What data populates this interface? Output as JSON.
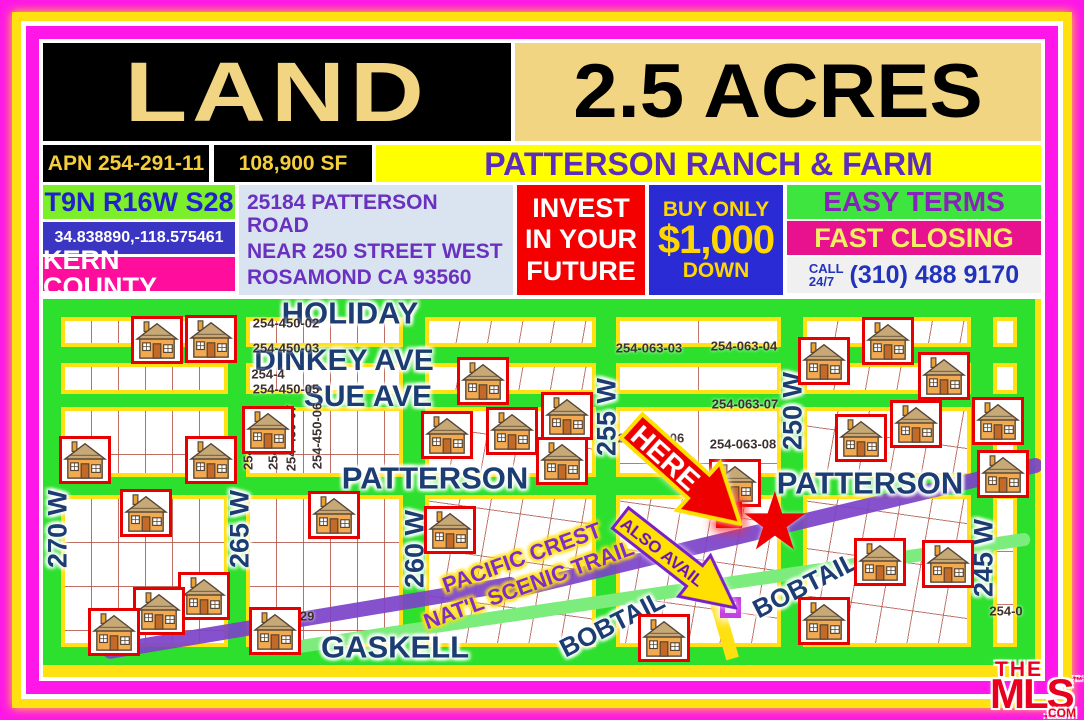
{
  "header": {
    "land": "LAND",
    "acres": "2.5 ACRES"
  },
  "info": {
    "apn": "APN 254-291-11",
    "sqft": "108,900 SF",
    "ranch_title": "PATTERSON RANCH & FARM",
    "township": "T9N R16W S28",
    "gps": "34.838890,-118.575461",
    "county": "KERN COUNTY",
    "address_line1": "25184 PATTERSON ROAD",
    "address_line2": "NEAR 250 STREET WEST",
    "address_line3": "ROSAMOND CA 93560"
  },
  "offer": {
    "invest_l1": "INVEST",
    "invest_l2": "IN YOUR",
    "invest_l3": "FUTURE",
    "buy_line1": "BUY ONLY",
    "amount": "$1,000",
    "buy_line2": "DOWN",
    "easy": "EASY TERMS",
    "fast": "FAST CLOSING",
    "call_l1": "CALL",
    "call_l2": "24/7",
    "phone": "(310) 488 9170"
  },
  "map": {
    "here_label": "HERE",
    "also_label": "ALSO AVAIL",
    "star_glyph": "★",
    "trail_label1": "PACIFIC CREST",
    "trail_label2": "NAT'L SCENIC TRAIL",
    "streets": [
      {
        "label": "HOLIDAY",
        "x": 307,
        "y": 14,
        "rot": 0,
        "fs": 31
      },
      {
        "label": "DINKEY AVE",
        "x": 301,
        "y": 62,
        "rot": 0,
        "fs": 30
      },
      {
        "label": "SUE AVE",
        "x": 325,
        "y": 98,
        "rot": 0,
        "fs": 30
      },
      {
        "label": "PATTERSON",
        "x": 392,
        "y": 179,
        "rot": 0,
        "fs": 31
      },
      {
        "label": "PATTERSON",
        "x": 827,
        "y": 184,
        "rot": 0,
        "fs": 31
      },
      {
        "label": "GASKELL",
        "x": 352,
        "y": 348,
        "rot": 0,
        "fs": 31
      },
      {
        "label": "BOBTAIL",
        "x": 569,
        "y": 325,
        "rot": -27,
        "fs": 26
      },
      {
        "label": "BOBTAIL",
        "x": 762,
        "y": 286,
        "rot": -27,
        "fs": 26
      },
      {
        "label": "270 W",
        "x": 15,
        "y": 230,
        "rot": -90,
        "fs": 27
      },
      {
        "label": "265 W",
        "x": 197,
        "y": 230,
        "rot": -90,
        "fs": 27
      },
      {
        "label": "260 W",
        "x": 372,
        "y": 250,
        "rot": -90,
        "fs": 27
      },
      {
        "label": "255 W",
        "x": 564,
        "y": 118,
        "rot": -90,
        "fs": 27
      },
      {
        "label": "250 W",
        "x": 750,
        "y": 112,
        "rot": -90,
        "fs": 27
      },
      {
        "label": "245 W",
        "x": 941,
        "y": 259,
        "rot": -90,
        "fs": 27
      }
    ],
    "parcels": [
      {
        "label": "254-450-02",
        "x": 243,
        "y": 24,
        "rot": 0
      },
      {
        "label": "254-450-03",
        "x": 243,
        "y": 49,
        "rot": 0
      },
      {
        "label": "254-4",
        "x": 225,
        "y": 75,
        "rot": 0
      },
      {
        "label": "254-450-05",
        "x": 243,
        "y": 90,
        "rot": 0
      },
      {
        "label": "254-",
        "x": 205,
        "y": 158,
        "rot": -90
      },
      {
        "label": "254-",
        "x": 230,
        "y": 158,
        "rot": -90
      },
      {
        "label": "254-450-07",
        "x": 248,
        "y": 139,
        "rot": -90
      },
      {
        "label": "254-450-06",
        "x": 274,
        "y": 137,
        "rot": -90
      },
      {
        "label": "254-063-03",
        "x": 606,
        "y": 49,
        "rot": 0
      },
      {
        "label": "254-063-04",
        "x": 701,
        "y": 47,
        "rot": 0
      },
      {
        "label": "254-063-07",
        "x": 702,
        "y": 105,
        "rot": 0
      },
      {
        "label": "254-063-06",
        "x": 608,
        "y": 139,
        "rot": 0
      },
      {
        "label": "254-063-08",
        "x": 700,
        "y": 145,
        "rot": 0
      },
      {
        "label": "-29",
        "x": 262,
        "y": 317,
        "rot": 0
      },
      {
        "label": "254-0",
        "x": 963,
        "y": 312,
        "rot": 0
      }
    ],
    "houses": [
      [
        114,
        41
      ],
      [
        168,
        40
      ],
      [
        42,
        161
      ],
      [
        168,
        161
      ],
      [
        225,
        131
      ],
      [
        440,
        82
      ],
      [
        404,
        136
      ],
      [
        469,
        132
      ],
      [
        524,
        117
      ],
      [
        519,
        162
      ],
      [
        692,
        184
      ],
      [
        781,
        62
      ],
      [
        845,
        42
      ],
      [
        901,
        77
      ],
      [
        873,
        125
      ],
      [
        818,
        139
      ],
      [
        955,
        122
      ],
      [
        960,
        175
      ],
      [
        407,
        231
      ],
      [
        291,
        216
      ],
      [
        103,
        214
      ],
      [
        161,
        297
      ],
      [
        116,
        312
      ],
      [
        71,
        333
      ],
      [
        232,
        332
      ],
      [
        621,
        339
      ],
      [
        837,
        263
      ],
      [
        905,
        265
      ],
      [
        781,
        322
      ]
    ]
  },
  "logo": {
    "the": "THE",
    "mls": "MLS",
    "tm": "™",
    "com": ".COM"
  },
  "colors": {
    "border_magenta": "#FF16E8",
    "border_yellow": "#FFE011",
    "banner_tan": "#F2D583",
    "title_purple": "#5B2DBE",
    "street_navy": "#1C3C74",
    "road_green": "#2EE02E",
    "bobtail_green": "#7CEC7C",
    "trail_purple": "#7C42C8",
    "invest_red": "#F40000",
    "buy_blue": "#2B2BD5",
    "kern_magenta": "#FF0E9E",
    "easy_green": "#3FE53F",
    "parcel_line": "#B25548",
    "house_border_red": "#E80000"
  }
}
